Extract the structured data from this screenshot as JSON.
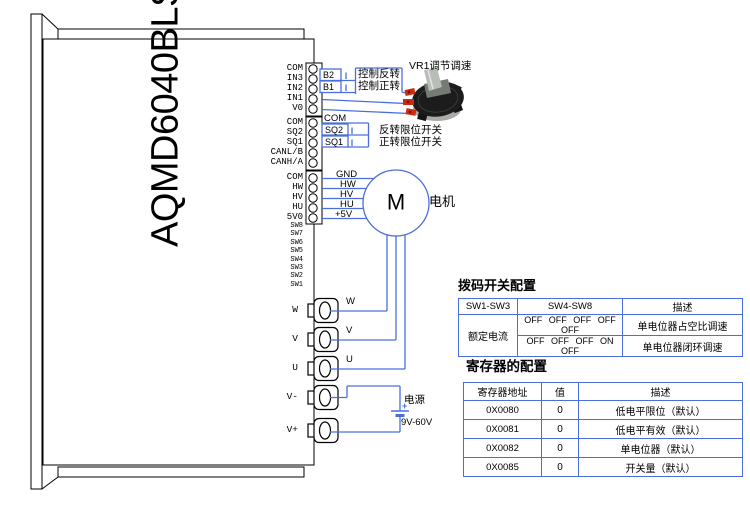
{
  "device": {
    "title": "AQMD6040BLS-Ex"
  },
  "pins": {
    "g1": [
      "COM",
      "IN3",
      "IN2",
      "IN1",
      "V0"
    ],
    "g2": [
      "COM",
      "SQ2",
      "SQ1",
      "CANL/B",
      "CANH/A"
    ],
    "g3": [
      "COM",
      "HW",
      "HV",
      "HU",
      "5V0"
    ],
    "sw": [
      "SW8",
      "SW7",
      "SW6",
      "SW5",
      "SW4",
      "SW3",
      "SW2",
      "SW1"
    ],
    "power": [
      "W",
      "V",
      "U",
      "V-",
      "V+"
    ]
  },
  "control": {
    "b2": "B2",
    "b1": "B1",
    "reverse": "控制反转",
    "forward": "控制正转",
    "vr1": "VR1调节调速",
    "com": "COM",
    "sq2": "SQ2",
    "sq1": "SQ1",
    "reverse_limit": "反转限位开关",
    "forward_limit": "正转限位开关"
  },
  "hall_wires": [
    "GND",
    "HW",
    "HV",
    "HU",
    "+5V"
  ],
  "motor": {
    "symbol": "M",
    "label": "电机"
  },
  "phase_wires": [
    "W",
    "V",
    "U"
  ],
  "power_supply": {
    "label": "电源",
    "plus": "+",
    "voltage": "9V-60V"
  },
  "dip_table": {
    "title": "拨码开关配置",
    "headers": [
      "SW1-SW3",
      "SW4-SW8",
      "描述"
    ],
    "row_label": "额定电流",
    "rows": [
      {
        "sw": "OFF OFF OFF OFF OFF",
        "desc": "单电位器占空比调速"
      },
      {
        "sw": "OFF OFF OFF ON OFF",
        "desc": "单电位器闭环调速"
      }
    ]
  },
  "register_table": {
    "title": "寄存器的配置",
    "headers": [
      "寄存器地址",
      "值",
      "描述"
    ],
    "rows": [
      {
        "addr": "0X0080",
        "val": "0",
        "desc": "低电平限位（默认）"
      },
      {
        "addr": "0X0081",
        "val": "0",
        "desc": "低电平有效（默认）"
      },
      {
        "addr": "0X0082",
        "val": "0",
        "desc": "单电位器（默认）"
      },
      {
        "addr": "0X0085",
        "val": "0",
        "desc": "开关量（默认）"
      }
    ]
  },
  "colors": {
    "wire": "#4a6fdc",
    "outline": "#000000"
  }
}
